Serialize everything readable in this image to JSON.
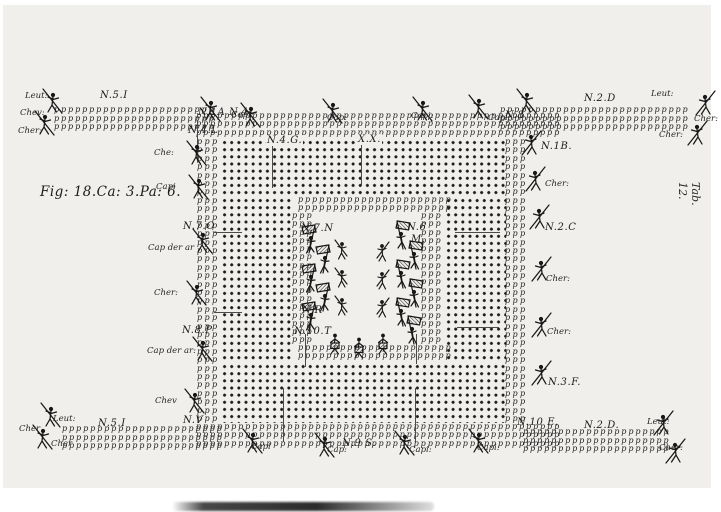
{
  "figure_caption": "Fig: 18.Ca: 3.Pa: 6.",
  "plate_number": "Tab. 12.",
  "ink_color": "#1b1b1b",
  "paper_color": "#f1efec",
  "musket_glyph": "p",
  "unit_labels": [
    {
      "text": "N.5.I",
      "x": 100,
      "y": 90
    },
    {
      "text": "N.1A N.4",
      "x": 198,
      "y": 107
    },
    {
      "text": "N.8",
      "x": 505,
      "y": 110
    },
    {
      "text": "N.2.D",
      "x": 584,
      "y": 93
    },
    {
      "text": "N.4.L",
      "x": 188,
      "y": 125
    },
    {
      "text": "N.1B.",
      "x": 541,
      "y": 141
    },
    {
      "text": "N.4.G.",
      "x": 266,
      "y": 135,
      "cls": "onDots"
    },
    {
      "text": "X.X.",
      "x": 357,
      "y": 134,
      "cls": "onDots"
    },
    {
      "text": "N.7.O",
      "x": 183,
      "y": 221
    },
    {
      "text": "N.2.C",
      "x": 545,
      "y": 222
    },
    {
      "text": "N.8.P",
      "x": 182,
      "y": 325
    },
    {
      "text": "N.3.F.",
      "x": 548,
      "y": 377
    },
    {
      "text": "N.V",
      "x": 183,
      "y": 415
    },
    {
      "text": "N.7.N",
      "x": 301,
      "y": 223
    },
    {
      "text": "N.6",
      "x": 407,
      "y": 222
    },
    {
      "text": "M.",
      "x": 411,
      "y": 234
    },
    {
      "text": "N.R",
      "x": 302,
      "y": 305
    },
    {
      "text": "N.10.T",
      "x": 294,
      "y": 326
    },
    {
      "text": "N.5.I",
      "x": 98,
      "y": 418
    },
    {
      "text": "N.9 S.",
      "x": 342,
      "y": 438
    },
    {
      "text": "N.10 E.",
      "x": 517,
      "y": 417
    },
    {
      "text": "N.2.D.",
      "x": 584,
      "y": 420
    }
  ],
  "officer_labels": [
    {
      "text": "Leut:",
      "x": 25,
      "y": 91
    },
    {
      "text": "Chev:",
      "x": 20,
      "y": 108
    },
    {
      "text": "Cher:",
      "x": 18,
      "y": 126
    },
    {
      "text": "Capi:",
      "x": 231,
      "y": 110
    },
    {
      "text": "Cap:",
      "x": 327,
      "y": 113
    },
    {
      "text": "Capi:",
      "x": 411,
      "y": 111
    },
    {
      "text": "Capi:",
      "x": 488,
      "y": 113
    },
    {
      "text": "Leut:",
      "x": 651,
      "y": 89
    },
    {
      "text": "Cher:",
      "x": 694,
      "y": 114
    },
    {
      "text": "Cher:",
      "x": 659,
      "y": 130
    },
    {
      "text": "Che:",
      "x": 154,
      "y": 148
    },
    {
      "text": "Capi",
      "x": 156,
      "y": 182
    },
    {
      "text": "Cap der ar",
      "x": 148,
      "y": 243
    },
    {
      "text": "Cher:",
      "x": 154,
      "y": 288
    },
    {
      "text": "Cap der ar:",
      "x": 147,
      "y": 346
    },
    {
      "text": "Chev",
      "x": 155,
      "y": 396
    },
    {
      "text": "Cher:",
      "x": 545,
      "y": 179
    },
    {
      "text": "Cher:",
      "x": 546,
      "y": 274
    },
    {
      "text": "Cher:",
      "x": 547,
      "y": 327
    },
    {
      "text": "Leut:",
      "x": 53,
      "y": 414
    },
    {
      "text": "Cher",
      "x": 19,
      "y": 424
    },
    {
      "text": "Cher",
      "x": 51,
      "y": 439
    },
    {
      "text": "Capi",
      "x": 251,
      "y": 442
    },
    {
      "text": "Cap:",
      "x": 327,
      "y": 445
    },
    {
      "text": "Capi:",
      "x": 409,
      "y": 445
    },
    {
      "text": "Capi:",
      "x": 477,
      "y": 443
    },
    {
      "text": "Leut:",
      "x": 647,
      "y": 417
    },
    {
      "text": "Cher:",
      "x": 659,
      "y": 443
    }
  ],
  "formation": {
    "musket_blocks": [
      {
        "name": "wing-top-left",
        "x": 54,
        "y": 106,
        "cols": 23,
        "rows": 3,
        "dx": 6.3,
        "dy": 8.6
      },
      {
        "name": "wing-top-right",
        "x": 500,
        "y": 106,
        "cols": 27,
        "rows": 3,
        "dx": 6.3,
        "dy": 8.6
      },
      {
        "name": "wing-bottom-left",
        "x": 62,
        "y": 425,
        "cols": 23,
        "rows": 3,
        "dx": 6.3,
        "dy": 8.6
      },
      {
        "name": "wing-bottom-right",
        "x": 523,
        "y": 428,
        "cols": 21,
        "rows": 3,
        "dx": 6.3,
        "dy": 8.6
      },
      {
        "name": "square-top-fringe",
        "x": 196,
        "y": 112,
        "cols": 52,
        "rows": 3,
        "dx": 6.3,
        "dy": 8.4
      },
      {
        "name": "square-bottom-fringe",
        "x": 196,
        "y": 423,
        "cols": 52,
        "rows": 3,
        "dx": 6.3,
        "dy": 8.4
      },
      {
        "name": "square-left-fringe",
        "x": 197,
        "y": 138,
        "cols": 3,
        "rows": 34,
        "dx": 6.8,
        "dy": 8.4
      },
      {
        "name": "square-right-fringe",
        "x": 505,
        "y": 138,
        "cols": 3,
        "rows": 34,
        "dx": 6.8,
        "dy": 8.4
      },
      {
        "name": "courtyard-top-fringe",
        "x": 298,
        "y": 196,
        "cols": 22,
        "rows": 2,
        "dx": 6.3,
        "dy": 8
      },
      {
        "name": "courtyard-bottom-fringe",
        "x": 298,
        "y": 344,
        "cols": 22,
        "rows": 2,
        "dx": 6.3,
        "dy": 8
      },
      {
        "name": "courtyard-left-fringe",
        "x": 292,
        "y": 212,
        "cols": 3,
        "rows": 16,
        "dx": 6.5,
        "dy": 8.3
      },
      {
        "name": "courtyard-right-fringe",
        "x": 421,
        "y": 212,
        "cols": 3,
        "rows": 16,
        "dx": 6.5,
        "dy": 8.3
      }
    ],
    "dot_bands": [
      {
        "name": "pike-block-top",
        "x": 220,
        "y": 138,
        "w": 286,
        "h": 58
      },
      {
        "name": "pike-block-bottom",
        "x": 220,
        "y": 362,
        "w": 286,
        "h": 61
      },
      {
        "name": "pike-block-left",
        "x": 220,
        "y": 196,
        "w": 72,
        "h": 166
      },
      {
        "name": "pike-block-right",
        "x": 444,
        "y": 196,
        "w": 62,
        "h": 166
      }
    ],
    "dividers_v": [
      {
        "x": 272,
        "y": 140,
        "len": 48
      },
      {
        "x": 361,
        "y": 138,
        "len": 48
      },
      {
        "x": 197,
        "y": 120,
        "len": 42
      },
      {
        "x": 305,
        "y": 334,
        "len": 33
      },
      {
        "x": 416,
        "y": 334,
        "len": 30
      },
      {
        "x": 283,
        "y": 388,
        "len": 54
      },
      {
        "x": 415,
        "y": 388,
        "len": 54
      }
    ],
    "dividers_h": [
      {
        "x": 214,
        "y": 232,
        "len": 28
      },
      {
        "x": 214,
        "y": 312,
        "len": 28
      },
      {
        "x": 455,
        "y": 232,
        "len": 45
      },
      {
        "x": 457,
        "y": 327,
        "len": 42
      }
    ]
  },
  "figures": [
    {
      "type": "officer",
      "x": 40,
      "y": 86
    },
    {
      "type": "officer",
      "x": 32,
      "y": 108
    },
    {
      "type": "officer",
      "x": 198,
      "y": 94
    },
    {
      "type": "officer",
      "x": 238,
      "y": 100
    },
    {
      "type": "officer",
      "x": 320,
      "y": 96
    },
    {
      "type": "officer",
      "x": 410,
      "y": 94
    },
    {
      "type": "officer",
      "x": 466,
      "y": 92
    },
    {
      "type": "officer",
      "x": 514,
      "y": 86
    },
    {
      "type": "officer",
      "x": 692,
      "y": 88,
      "flip": true
    },
    {
      "type": "officer",
      "x": 684,
      "y": 118,
      "flip": true
    },
    {
      "type": "officer",
      "x": 184,
      "y": 138
    },
    {
      "type": "officer",
      "x": 186,
      "y": 172
    },
    {
      "type": "officer",
      "x": 190,
      "y": 226
    },
    {
      "type": "officer",
      "x": 184,
      "y": 278
    },
    {
      "type": "officer",
      "x": 190,
      "y": 334
    },
    {
      "type": "officer",
      "x": 182,
      "y": 386
    },
    {
      "type": "officer",
      "x": 518,
      "y": 128,
      "flip": true
    },
    {
      "type": "officer",
      "x": 522,
      "y": 164,
      "flip": true
    },
    {
      "type": "officer",
      "x": 526,
      "y": 202,
      "flip": true
    },
    {
      "type": "officer",
      "x": 528,
      "y": 254,
      "flip": true
    },
    {
      "type": "officer",
      "x": 528,
      "y": 310,
      "flip": true
    },
    {
      "type": "officer",
      "x": 528,
      "y": 358,
      "flip": true
    },
    {
      "type": "officer",
      "x": 38,
      "y": 400
    },
    {
      "type": "officer",
      "x": 30,
      "y": 422
    },
    {
      "type": "officer",
      "x": 240,
      "y": 426
    },
    {
      "type": "officer",
      "x": 312,
      "y": 430
    },
    {
      "type": "officer",
      "x": 392,
      "y": 428
    },
    {
      "type": "officer",
      "x": 466,
      "y": 426
    },
    {
      "type": "officer",
      "x": 650,
      "y": 408,
      "flip": true
    },
    {
      "type": "officer",
      "x": 662,
      "y": 436,
      "flip": true
    },
    {
      "type": "ensign",
      "x": 298,
      "y": 222
    },
    {
      "type": "ensign",
      "x": 312,
      "y": 242
    },
    {
      "type": "ensign",
      "x": 298,
      "y": 261
    },
    {
      "type": "ensign",
      "x": 312,
      "y": 280
    },
    {
      "type": "ensign",
      "x": 298,
      "y": 299
    },
    {
      "type": "ensign",
      "x": 388,
      "y": 218,
      "flip": true
    },
    {
      "type": "ensign",
      "x": 401,
      "y": 238,
      "flip": true
    },
    {
      "type": "ensign",
      "x": 388,
      "y": 257,
      "flip": true
    },
    {
      "type": "ensign",
      "x": 401,
      "y": 276,
      "flip": true
    },
    {
      "type": "ensign",
      "x": 388,
      "y": 295,
      "flip": true
    },
    {
      "type": "ensign",
      "x": 399,
      "y": 313,
      "flip": true
    },
    {
      "type": "soldier",
      "x": 332,
      "y": 236
    },
    {
      "type": "soldier",
      "x": 332,
      "y": 264
    },
    {
      "type": "soldier",
      "x": 332,
      "y": 292
    },
    {
      "type": "soldier",
      "x": 372,
      "y": 238,
      "flip": true
    },
    {
      "type": "soldier",
      "x": 372,
      "y": 266,
      "flip": true
    },
    {
      "type": "soldier",
      "x": 372,
      "y": 294,
      "flip": true
    },
    {
      "type": "drummer",
      "x": 324,
      "y": 330
    },
    {
      "type": "drummer",
      "x": 348,
      "y": 334
    },
    {
      "type": "drummer",
      "x": 372,
      "y": 330
    }
  ]
}
